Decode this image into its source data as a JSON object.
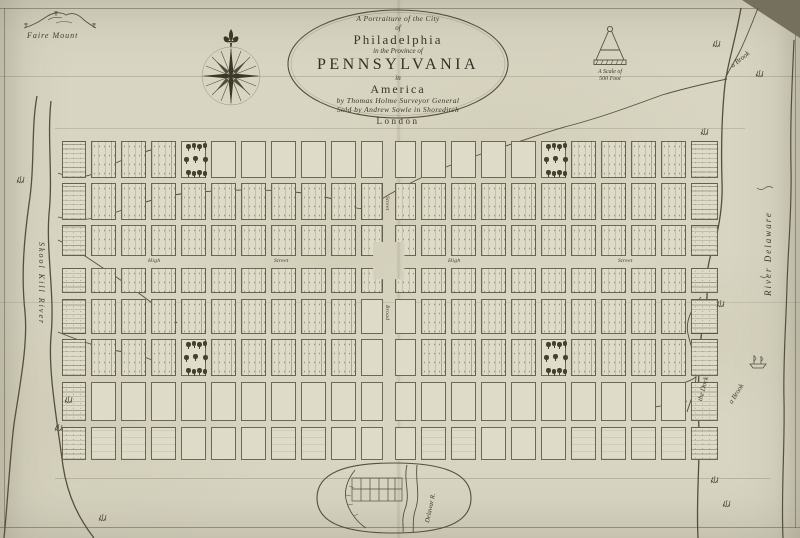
{
  "cartouche": {
    "lines": [
      "A Portraiture of the City",
      "of",
      "Philadelphia",
      "in the Province of",
      "PENNSYLVANIA",
      "in",
      "America",
      "by Thomas Holme Surveyor General",
      "Sold by Andrew Sowle in Shoreditch",
      "London"
    ]
  },
  "landmarks": {
    "faire_mount": "Faire Mount",
    "brook_top": "a Brook",
    "brook_bottom": "a Brook",
    "dock": "the Dock"
  },
  "rivers": {
    "schuylkill": "Skool Kill River",
    "delaware": "River Delaware",
    "inset_delaware": "Delawar R.",
    "jersey": "Jersey",
    "new": "New"
  },
  "streets": {
    "high_1": "High",
    "street_1": "Street",
    "high_2": "High",
    "street_2": "Street",
    "broad_upper": "Street",
    "broad_lower": "Broad"
  },
  "scale": {
    "line1": "A Scale of",
    "line2": "500 Foot"
  }
}
